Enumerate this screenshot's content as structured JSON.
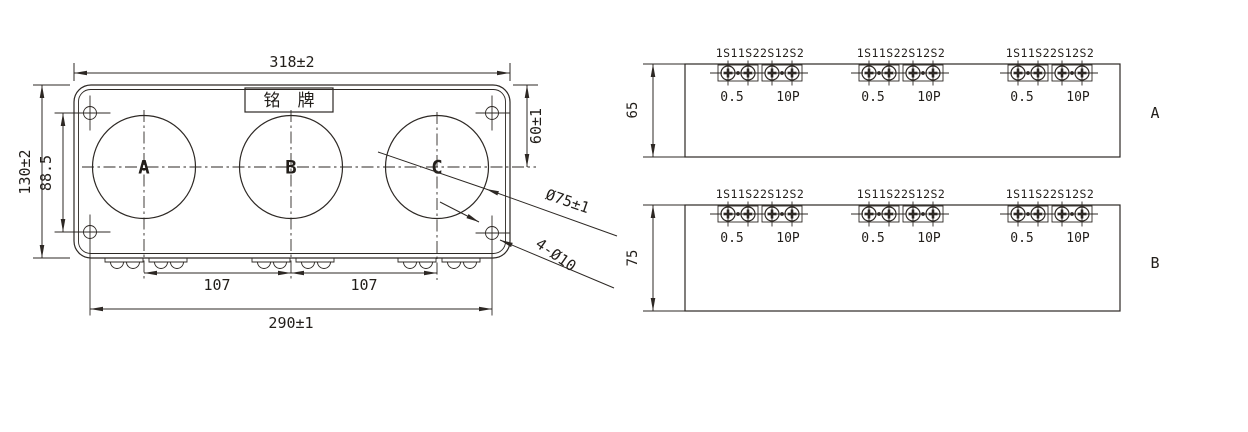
{
  "front_view": {
    "nameplate": "铭　牌",
    "phases": [
      "A",
      "B",
      "C"
    ],
    "dims": {
      "overall_width": "318±2",
      "overall_height": "130±2",
      "hole_span": "88.5",
      "top_to_center": "60±1",
      "aperture_dia": "Ø75±1",
      "mount_holes": "4-Ø10",
      "pitch_ab": "107",
      "pitch_bc": "107",
      "terminal_span": "290±1"
    }
  },
  "terminal_group": {
    "row_label": "1S11S22S12S2",
    "left_class": "0.5",
    "right_class": "10P"
  },
  "side_views": [
    {
      "label": "A",
      "height": "65"
    },
    {
      "label": "B",
      "height": "75"
    }
  ]
}
